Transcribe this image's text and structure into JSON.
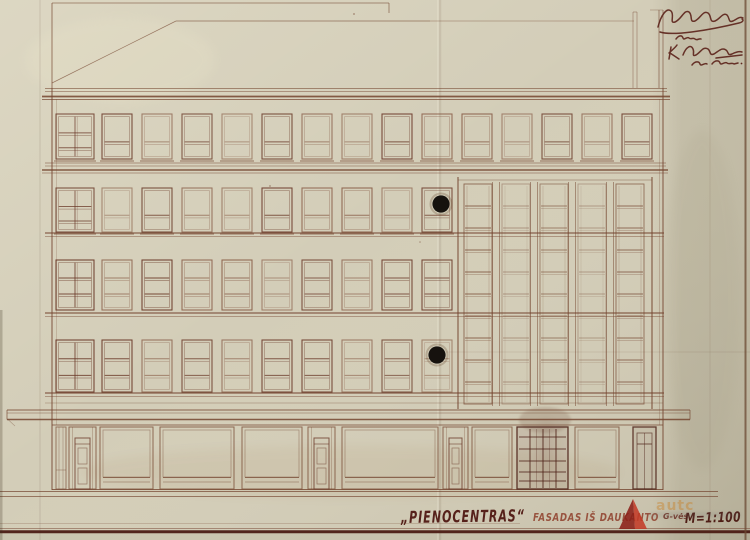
{
  "sheet": {
    "titleblock": {
      "project": "„PIENOCENTRAS“",
      "facade_label": "FASADAS IŠ DAUKANTO",
      "street_suffix": "G-vės",
      "scale": "M=1:100"
    },
    "watermark": {
      "text": "autc"
    },
    "colors": {
      "paper": "#d3cdb8",
      "paper_margin": "#8f8870",
      "ink": "#74452f",
      "ink_dark": "#5a2a1e",
      "title_ink": "#56211a",
      "watermark_orange": "#c97d1e",
      "watermark_red_dark": "#8c2018",
      "watermark_red_bright": "#c33b28",
      "ground_line": "#4a1b13",
      "punch_hole": "#16120e"
    }
  }
}
